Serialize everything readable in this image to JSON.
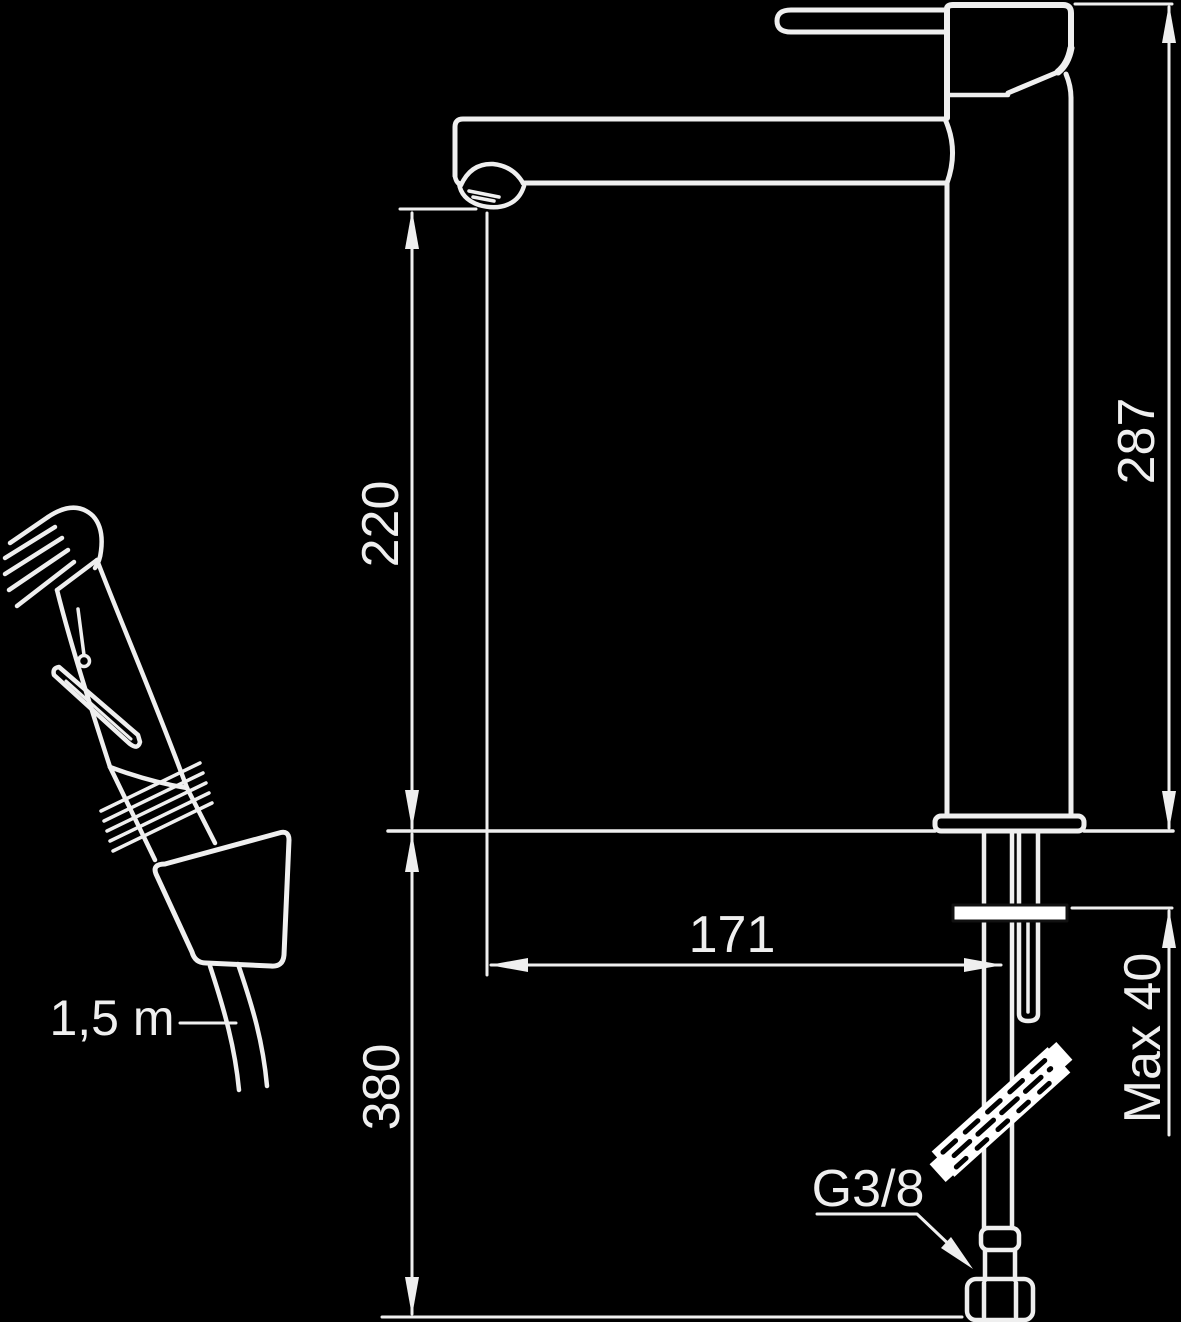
{
  "page": {
    "title": "Faucet installation dimension drawing",
    "background_color": "#000000"
  },
  "drawing": {
    "line_color": "#efefef",
    "highlight_fill": "#ffffff",
    "labels": {
      "spout_height": "220",
      "total_height": "287",
      "spout_reach": "171",
      "under_deck_length": "380",
      "max_deck_thickness": "Max 40",
      "thread_size": "G3/8",
      "hose_length": "1,5 m"
    },
    "components": [
      "hand-spray-head",
      "spray-trigger",
      "spray-handle",
      "spray-holder-cone",
      "spray-hose",
      "lever-handle",
      "mixer-body",
      "spout",
      "aerator",
      "riser-column",
      "base-plate",
      "counter-deck-line",
      "mounting-washer",
      "supply-hose",
      "hose-break-symbol",
      "g38-connection-nut"
    ]
  }
}
